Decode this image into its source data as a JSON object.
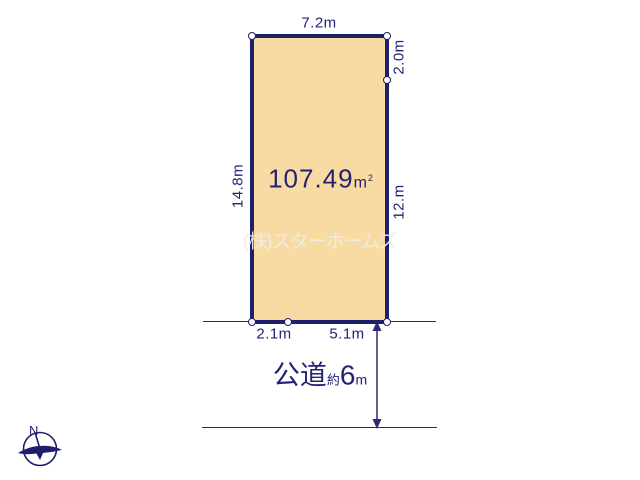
{
  "diagram": {
    "area": {
      "value": "107.49",
      "unit": "m",
      "unit_sup": "2"
    },
    "dimensions": {
      "top": "7.2m",
      "right_upper": "2.0m",
      "right_lower": "12.m",
      "left": "14.8m",
      "bottom_left": "2.1m",
      "bottom_right": "5.1m"
    },
    "road": {
      "main": "公道",
      "approx": "約",
      "value": "6",
      "unit": "m"
    },
    "watermark": "(株)スターホームズ",
    "compass": {
      "north_label": "N"
    },
    "colors": {
      "plot_fill": "#f8dba2",
      "outline": "#1e1e6a",
      "text": "#232274",
      "watermark": "#eeece6",
      "background": "#ffffff"
    }
  }
}
